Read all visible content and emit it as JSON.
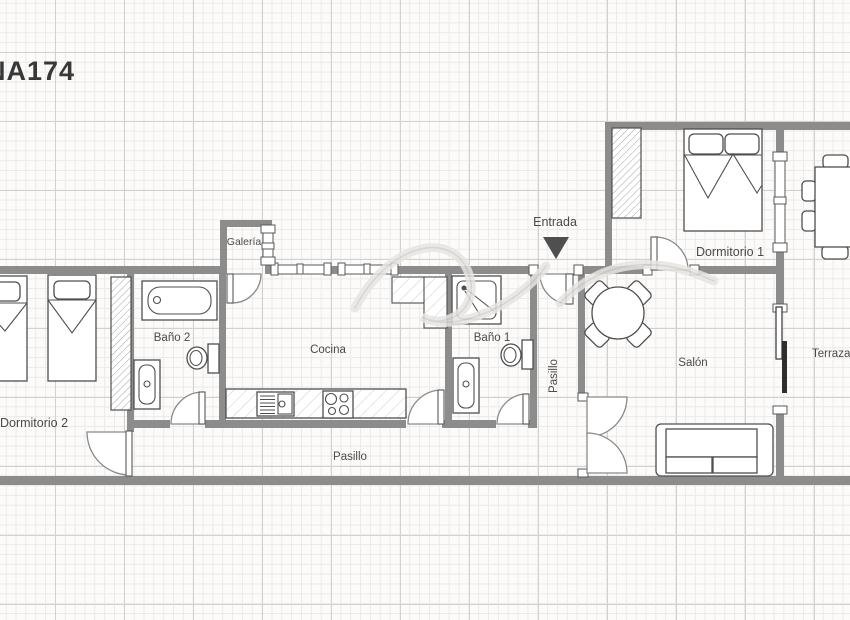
{
  "plan_id": "NA174",
  "labels": {
    "entrada": "Entrada",
    "galeria": "Galería",
    "dormitorio_1": "Dormitorio 1",
    "dormitorio_2": "Dormitorio 2",
    "bano_1": "Baño 1",
    "bano_2": "Baño 2",
    "cocina": "Cocina",
    "salon": "Salón",
    "terraza": "Terraza",
    "pasillo_vertical": "Pasillo",
    "pasillo_horizontal": "Pasillo"
  },
  "colors": {
    "wall": "#8c8c8c",
    "furniture_outline": "#4f4f4f",
    "label_text": "#4a4a4a",
    "grid_minor": "#eceae8",
    "grid_major": "#d3d1cf",
    "background": "#fcfbfa",
    "sliding_panel_dark": "#2f2f2f",
    "entrance_arrow": "#4f4f4f"
  },
  "furniture": {
    "dormitorio_1": [
      "wardrobe",
      "double-bed",
      "window"
    ],
    "dormitorio_2": [
      "single-bed",
      "single-bed",
      "wardrobe"
    ],
    "bano_1": [
      "shower",
      "toilet",
      "bathtub"
    ],
    "bano_2": [
      "bathtub",
      "toilet",
      "washbasin-tub"
    ],
    "cocina": [
      "worktop-counter",
      "sink",
      "stove",
      "fridge-counter",
      "windows"
    ],
    "salon": [
      "round-table",
      "four-chairs",
      "sofa",
      "sliding-door"
    ],
    "terraza": [
      "dining-table",
      "four-chairs"
    ]
  }
}
